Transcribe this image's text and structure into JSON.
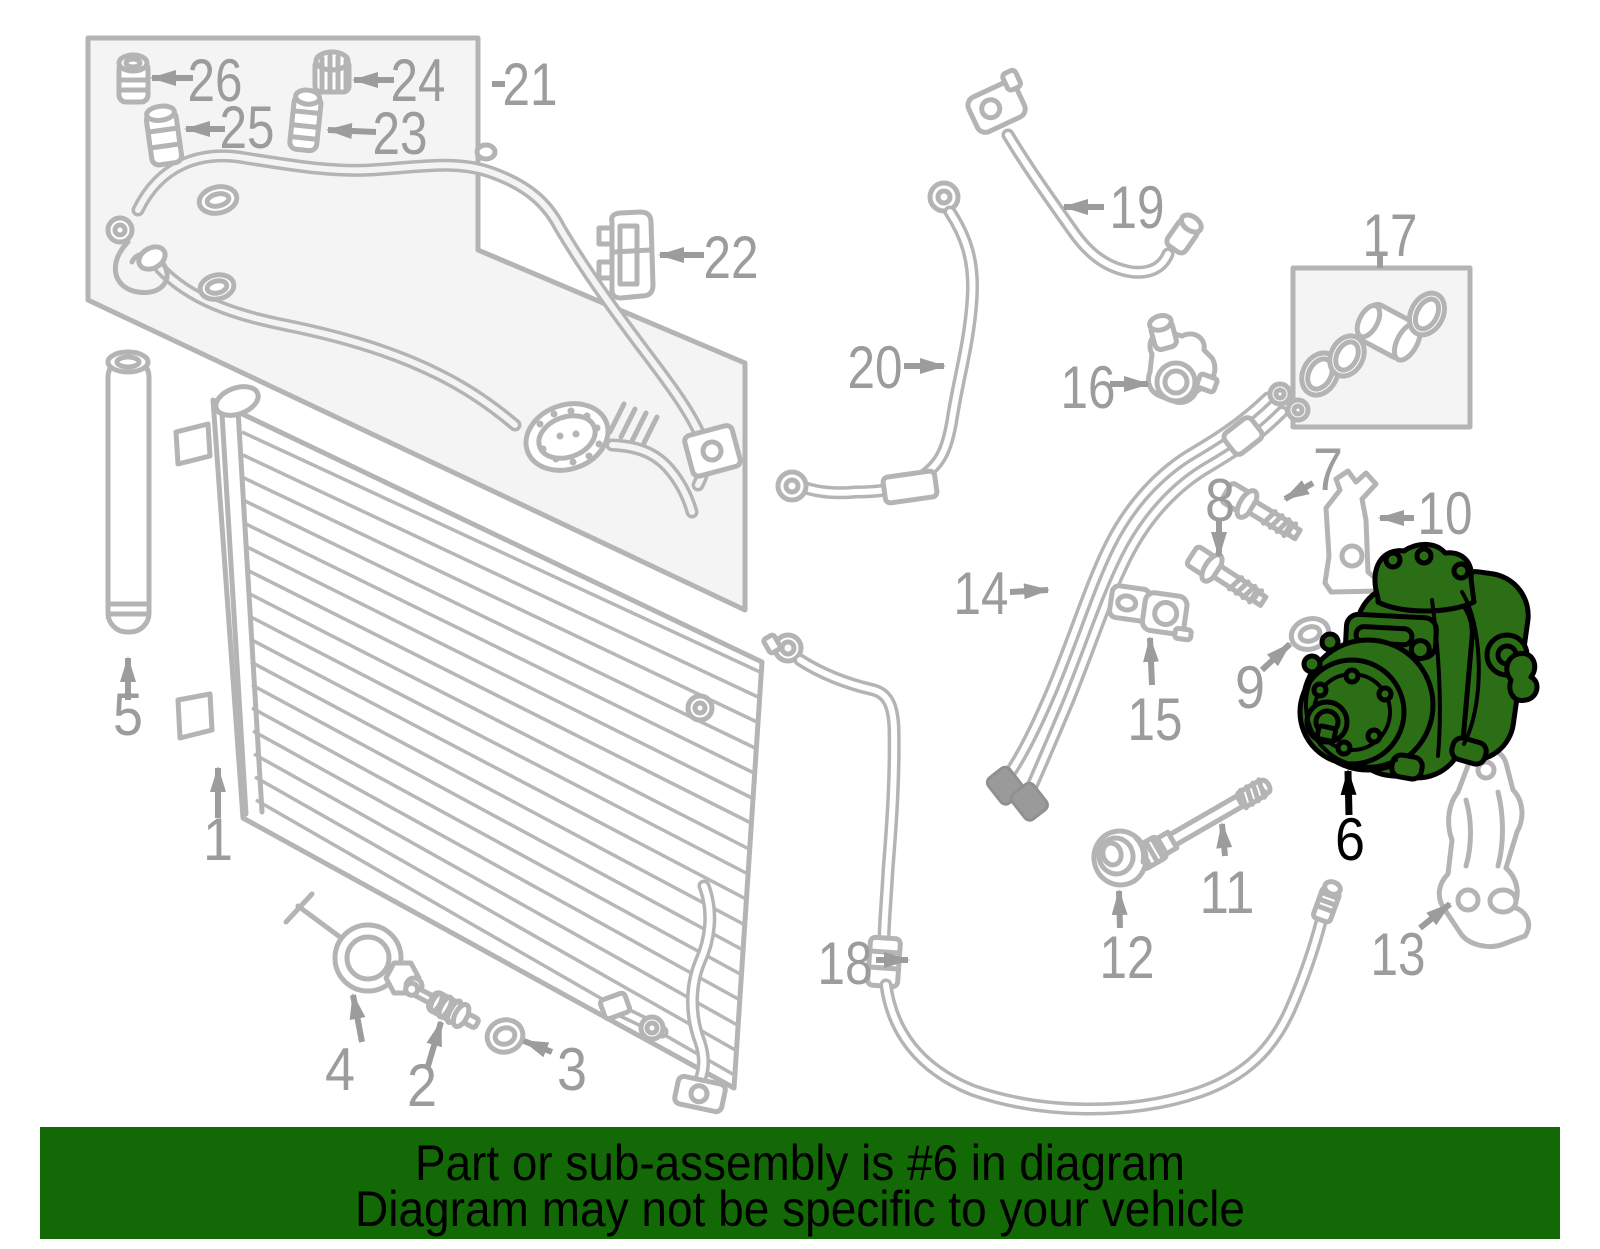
{
  "banner": {
    "line1": "Part or sub-assembly is #6 in diagram",
    "line2": "Diagram may not be specific to your vehicle",
    "bg_color": "#136906",
    "text_color": "#000000"
  },
  "diagram": {
    "type": "exploded-parts-diagram",
    "subject": "A/C condenser, compressor and lines",
    "highlighted_part": "6",
    "line_color": "#b4b4b4",
    "label_color": "#9c9c9c",
    "highlight_fill": "#2c6e16",
    "highlight_outline": "#000000",
    "callouts": [
      "1",
      "2",
      "3",
      "4",
      "5",
      "6",
      "7",
      "8",
      "9",
      "10",
      "11",
      "12",
      "13",
      "14",
      "15",
      "16",
      "17",
      "18",
      "19",
      "20",
      "21",
      "22",
      "23",
      "24",
      "25",
      "26"
    ]
  }
}
